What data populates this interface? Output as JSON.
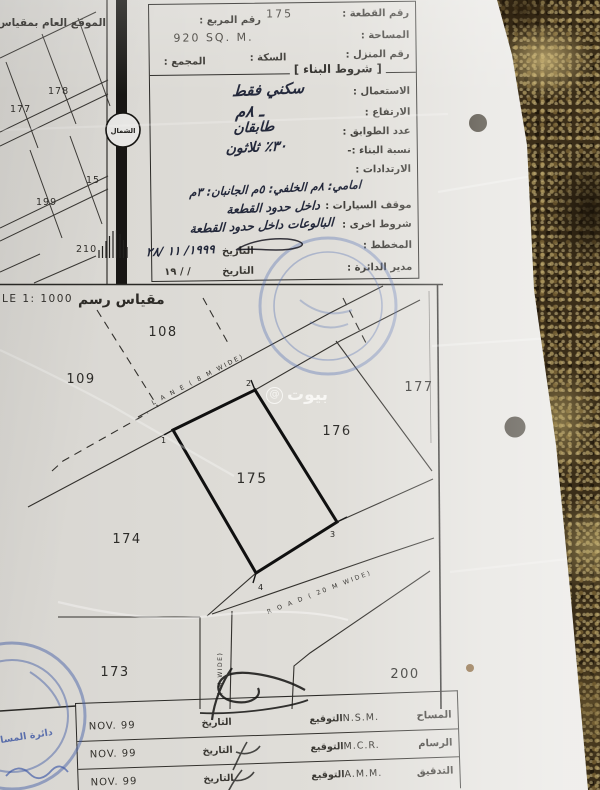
{
  "colors": {
    "paper": "#e0ded9",
    "ink": "#2b2a27",
    "hand_ink": "#23283b",
    "stamp_blue": "#3a54a6",
    "carpet": "#3a2d18"
  },
  "header_table": {
    "plot_no_label": "رقم القطعة :",
    "plot_no": "175",
    "square_label": "رقم المربع :",
    "area_label": "المساحة :",
    "area_value": "920 SQ. M.",
    "house_label": "رقم المنزل :",
    "street_label": "السكة :",
    "complex_label": "المجمع :",
    "conditions_title": "[ شروط البناء ]",
    "use_label": "الاستعمال :",
    "use_value": "سكني فقط",
    "height_label": "الارتفاع :",
    "height_value": "ـ ٨م",
    "floors_label": "عدد الطوابق :",
    "floors_value": "طابقان",
    "ratio_label": "نسبة البناء :-",
    "ratio_value": "٣٠٪ ثلاثون",
    "setbacks_label": "الارتدادات :",
    "setbacks_value": "امامي: ٨م الخلفي: ٥م الجانبان: ٣م",
    "parking_label": "موقف السيارات :",
    "parking_value": "داخل حدود القطعة",
    "other_label": "شروط اخرى :",
    "other_value": "البالوعات داخل حدود القطعة",
    "planner_label": "المخطط :",
    "date_label": "التاريخ",
    "planner_date": "١٩٩٩/ ١١ /٢٨",
    "director_label": "مدير الدائرة :",
    "director_date": "١٩  /    /"
  },
  "overview_map": {
    "title": "الموقع العام بمقياس",
    "north_label": "الشمال",
    "plot_labels": [
      "177",
      "178",
      "199",
      "15",
      "210"
    ]
  },
  "site_map": {
    "scale_en": "LE 1:  1000",
    "scale_ar": "مقياس رسم",
    "plot_labels": [
      "108",
      "109",
      "177",
      "176",
      "175",
      "174",
      "173",
      "200"
    ],
    "corner_labels": [
      "1",
      "2",
      "3",
      "4"
    ],
    "lane_label": "L A N E ( 8 M WIDE)",
    "road_label": "R O A D ( 20 M WIDE)",
    "side_road_label": "( M WIDE)",
    "watermark": "بيوت",
    "watermark_at": "@"
  },
  "footer_table": {
    "sign_label": "التوقيع",
    "date_label": "التاريخ",
    "rows": [
      {
        "role": "المساح",
        "initials": "N.S.M.",
        "date": "NOV. 99"
      },
      {
        "role": "الرسام",
        "initials": "M.C.R.",
        "date": "NOV. 99"
      },
      {
        "role": "التدقيق",
        "initials": "A.M.M.",
        "date": "NOV. 99"
      }
    ]
  },
  "annotations": {
    "stamp_text": "دائرة المسا"
  }
}
